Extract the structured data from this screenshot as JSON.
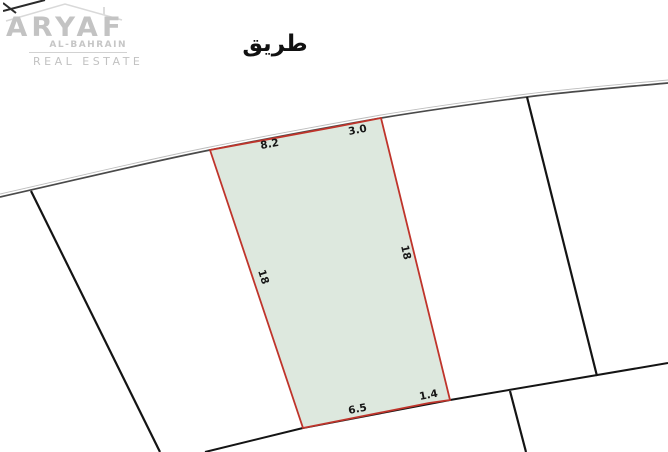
{
  "logo": {
    "brand": "ARYAF",
    "region": "AL-BAHRAIN",
    "tagline": "REAL ESTATE",
    "color": "#c3c3c3"
  },
  "map": {
    "road_label": "طريق",
    "plot": {
      "fill_color": "#dde8de",
      "border_color": "#bf342b",
      "dimensions": {
        "top": [
          "8.2",
          "3.0"
        ],
        "right": "18",
        "bottom": [
          "6.5",
          "1.4"
        ],
        "left": "18"
      }
    },
    "colors": {
      "parcel_line": "#141414",
      "road_line": "#4a4a4a",
      "label_text": "#161616",
      "background": "#ffffff"
    }
  }
}
